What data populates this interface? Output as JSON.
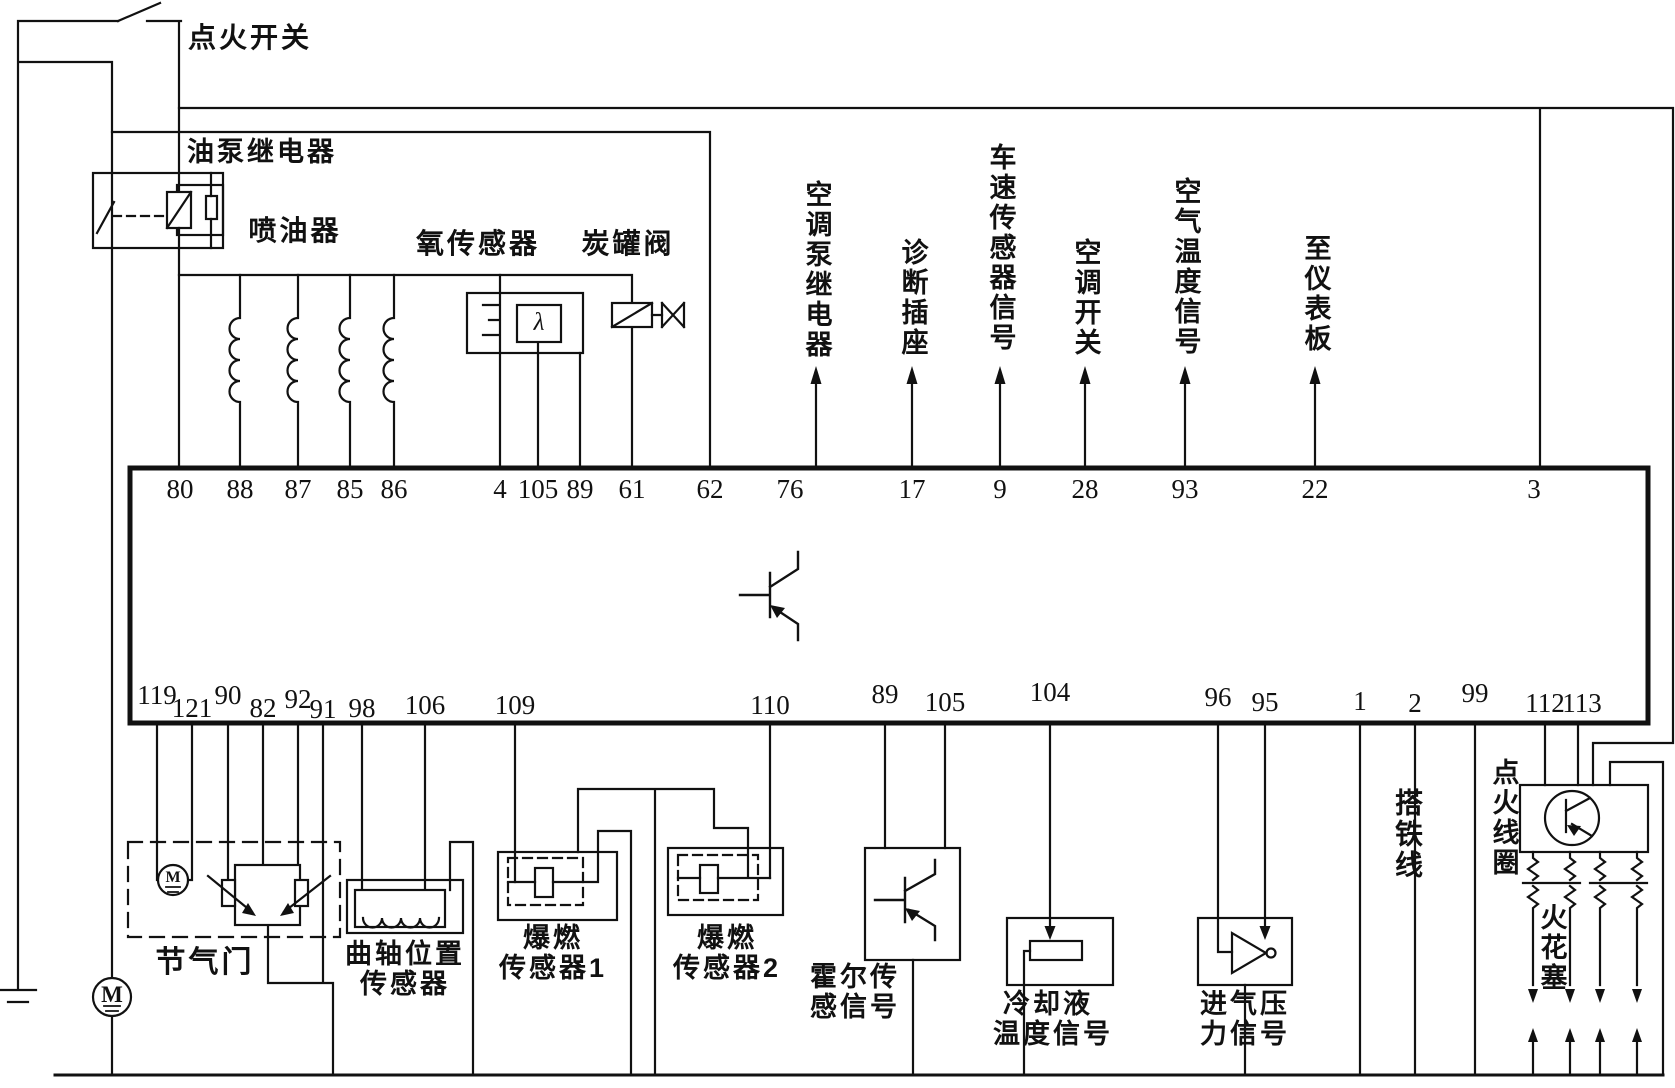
{
  "colors": {
    "line": "#111111",
    "background": "#ffffff"
  },
  "labels": {
    "ignition_switch": "点火开关",
    "fuel_pump_relay": "油泵继电器",
    "injectors": "喷油器",
    "oxygen_sensor": "氧传感器",
    "lambda": "λ",
    "canister_valve": "炭罐阀",
    "ac_pump_relay": "空调泵继电器",
    "diagnostic_socket": "诊断插座",
    "vehicle_speed_signal": "车速传感器信号",
    "ac_switch": "空调开关",
    "air_temp_signal": "空气温度信号",
    "to_instrument_panel": "至仪表板",
    "throttle": "节气门",
    "crank_sensor_line1": "曲轴位置",
    "crank_sensor_line2": "传感器",
    "knock1_line1": "爆燃",
    "knock1_line2": "传感器1",
    "knock2_line1": "爆燃",
    "knock2_line2": "传感器2",
    "hall_line1": "霍尔传",
    "hall_line2": "感信号",
    "coolant_line1": "冷却液",
    "coolant_line2": "温度信号",
    "pressure_line1": "进气压",
    "pressure_line2": "力信号",
    "ground_wire": "搭铁线",
    "ignition_coil": "点火线圈",
    "spark_plug": "火花塞",
    "motor": "M"
  },
  "ecu": {
    "top_pins": [
      "80",
      "88",
      "87",
      "85",
      "86",
      "4",
      "105",
      "89",
      "61",
      "62",
      "76",
      "17",
      "9",
      "28",
      "93",
      "22",
      "3"
    ],
    "bottom_pins": [
      "119",
      "121",
      "90",
      "82",
      "92",
      "91",
      "98",
      "106",
      "109",
      "110",
      "89",
      "105",
      "104",
      "96",
      "95",
      "1",
      "2",
      "99",
      "112",
      "113"
    ]
  }
}
